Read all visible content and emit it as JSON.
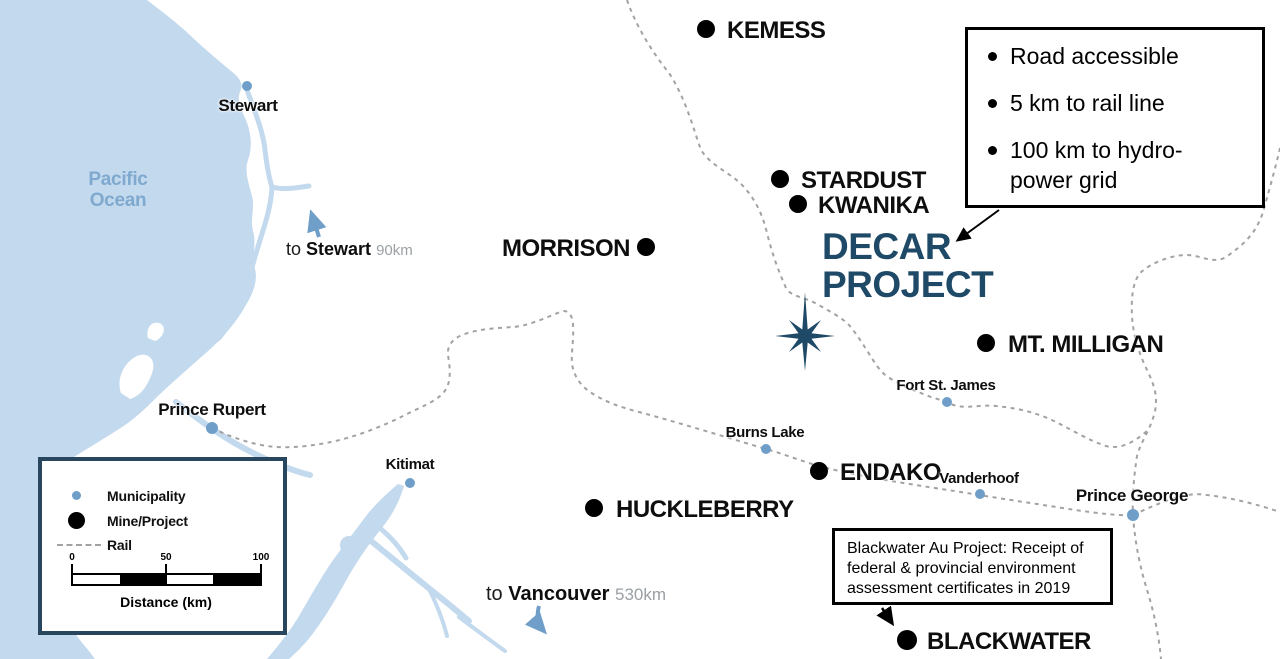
{
  "map": {
    "ocean": {
      "line1": "Pacific",
      "line2": "Ocean"
    },
    "mines": [
      {
        "label": "KEMESS"
      },
      {
        "label": "STARDUST"
      },
      {
        "label": "KWANIKA"
      },
      {
        "label": "MORRISON"
      },
      {
        "label": "MT. MILLIGAN"
      },
      {
        "label": "ENDAKO"
      },
      {
        "label": "HUCKLEBERRY"
      },
      {
        "label": "BLACKWATER"
      }
    ],
    "municipalities": [
      {
        "label": "Stewart"
      },
      {
        "label": "Prince Rupert"
      },
      {
        "label": "Kitimat"
      },
      {
        "label": "Fort St. James"
      },
      {
        "label": "Burns Lake"
      },
      {
        "label": "Vanderhoof"
      },
      {
        "label": "Prince George"
      }
    ],
    "project": {
      "line1": "DECAR",
      "line2": "PROJECT"
    },
    "routes": [
      {
        "prefix": "to ",
        "place": "Stewart",
        "distance": "90km"
      },
      {
        "prefix": "to ",
        "place": "Vancouver",
        "distance": "530km"
      }
    ]
  },
  "callouts": {
    "features": {
      "items": [
        "Road accessible",
        "5 km to rail line",
        "100 km to hydro-power grid"
      ]
    },
    "blackwater": {
      "text": "Blackwater Au Project: Receipt of federal & provincial environment assessment certificates in 2019"
    }
  },
  "legend": {
    "items": [
      {
        "label": "Municipality"
      },
      {
        "label": "Mine/Project"
      },
      {
        "label": "Rail"
      }
    ],
    "scale": {
      "ticks": [
        "0",
        "50",
        "100"
      ],
      "caption": "Distance (km)"
    }
  },
  "colors": {
    "water": "#c3d9ee",
    "ocean_text": "#7fa9cf",
    "municipality_dot": "#6f9fc8",
    "navy": "#1e4a68",
    "rail": "#a2a2a2",
    "distance_text": "#9aa0a4"
  }
}
